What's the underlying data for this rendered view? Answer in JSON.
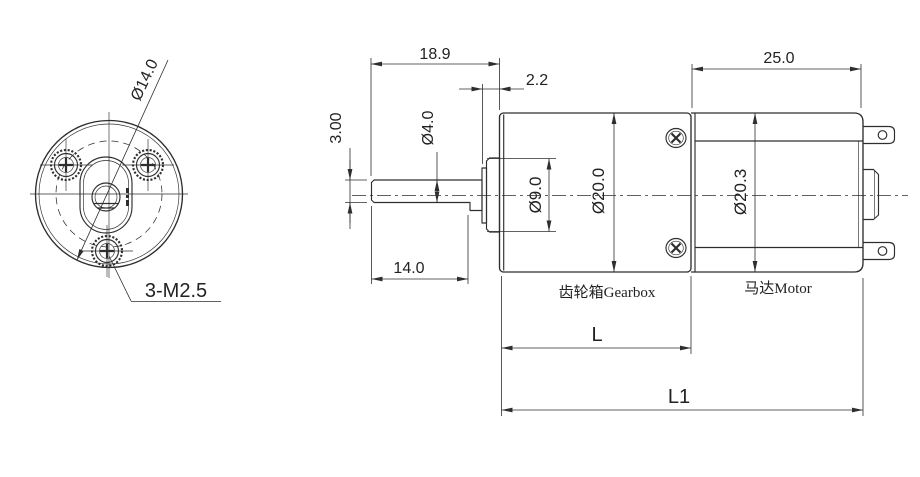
{
  "drawing": {
    "front_view": {
      "bolt_circle_label": "Ø14.0",
      "screw_label": "3-M2.5"
    },
    "side_view": {
      "dim_shaft_length": "18.9",
      "dim_boss_protrusion": "2.2",
      "dim_flat_depth": "3.00",
      "dim_shaft_diameter": "Ø4.0",
      "dim_flat_length": "14.0",
      "dim_boss_diameter": "Ø9.0",
      "dim_gearbox_diameter": "Ø20.0",
      "dim_gearbox_length": "L",
      "dim_motor_length": "25.0",
      "dim_motor_diameter": "Ø20.3",
      "dim_total_length": "L1",
      "label_gearbox": "齿轮箱Gearbox",
      "label_motor": "马达Motor"
    },
    "colors": {
      "line": "#2e2e2e",
      "background": "#ffffff"
    }
  }
}
